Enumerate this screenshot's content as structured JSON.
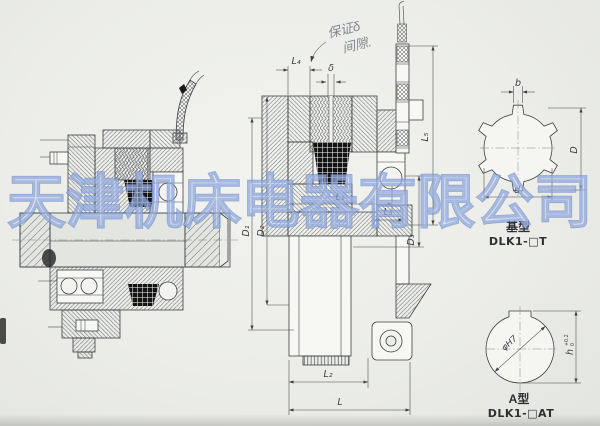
{
  "drawing": {
    "watermark": "天津机床电器有限公司",
    "note": {
      "line1": "保证δ",
      "line2": "间隙."
    },
    "dims": {
      "l4": "L₄",
      "delta": "δ",
      "d1": "D₁",
      "d2": "D₂",
      "l1": "L₁",
      "l3": "L₃",
      "d3": "D₃",
      "l5": "L₅",
      "l2": "L₂",
      "l": "L"
    },
    "spline_view": {
      "b": "b",
      "D": "D",
      "d": "d",
      "type": "基型",
      "model": "DLK1-□T"
    },
    "bore_view": {
      "dia": "φH7",
      "h": "h",
      "h_tol_up": "+0.2",
      "h_tol_dn": "0",
      "type": "A型",
      "model": "DLK1-□AT"
    }
  }
}
